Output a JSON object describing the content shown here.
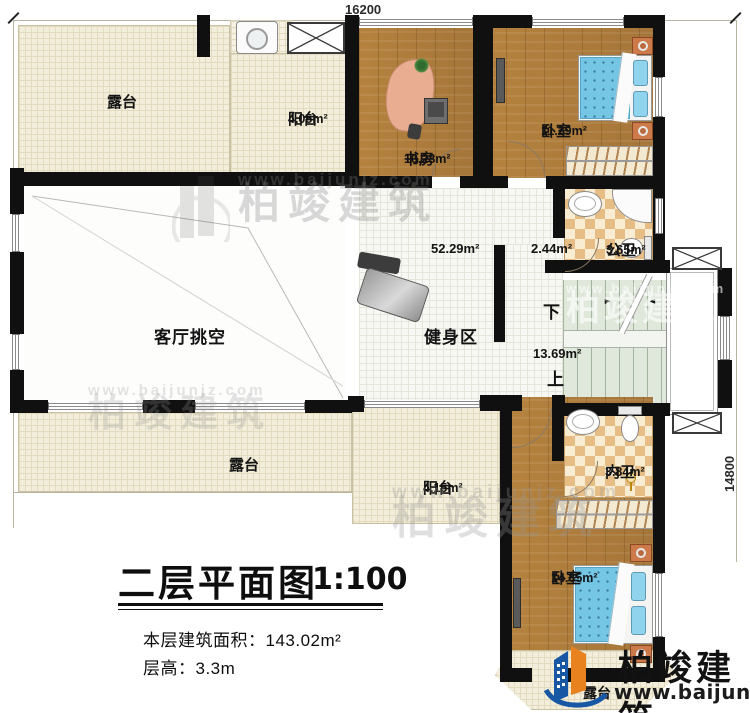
{
  "dimensions": {
    "width_label": "16200",
    "height_label": "14800"
  },
  "rooms": {
    "terrace_top": {
      "name": "露台"
    },
    "balcony_top": {
      "name": "阳台",
      "area": "4.05m²"
    },
    "study": {
      "name": "书房",
      "area": "10.28m²"
    },
    "bedroom_top": {
      "name": "卧室",
      "area": "11.29m²"
    },
    "bath_public": {
      "name": "公卫",
      "area": "3.65m²"
    },
    "hallway": {
      "area": "2.44m²"
    },
    "gym": {
      "name": "健身区",
      "area": "52.29m²"
    },
    "living_void": {
      "name": "客厅挑空"
    },
    "stairwell": {
      "area": "13.69m²",
      "down": "下",
      "up": "上"
    },
    "terrace_bottom": {
      "name": "露台"
    },
    "balcony_bottom": {
      "name": "阳台",
      "area": "4.15m²"
    },
    "bath_private": {
      "name": "内卫",
      "area": "3.84m²"
    },
    "bedroom_bottom": {
      "name": "卧室",
      "area": "14.85m²"
    },
    "terrace_small": {
      "name": "露台"
    }
  },
  "stairs_arrows": {
    "left": "►",
    "right": "◄"
  },
  "title": {
    "main": "二层平面图",
    "scale": "1:100",
    "floor_area": "本层建筑面积：143.02m²",
    "floor_height": "层高：3.3m"
  },
  "brand": {
    "name": "柏竣建筑",
    "website": "www.baijunjz.com"
  },
  "watermark": {
    "name": "柏竣建筑",
    "website": "www.baijunjz.com"
  },
  "colors": {
    "wall": "#101010",
    "wood": "#ae7c3c",
    "tile_light": "#f8ecd2",
    "tile_dark": "#e5bd85",
    "terrace": "#f2eedb",
    "stairs": "#dfe8db",
    "bed": "#74c6e4",
    "nightstand": "#cd7a4b",
    "logo_blue": "#1857a4",
    "logo_orange": "#e8821e"
  }
}
